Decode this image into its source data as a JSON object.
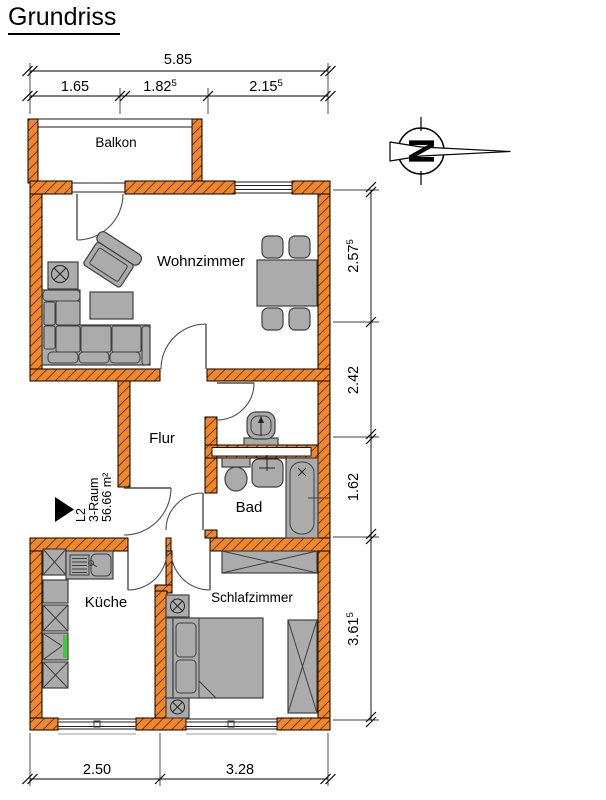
{
  "title": "Grundriss",
  "apartment": {
    "code": "L2",
    "type": "3-Raum",
    "area": "56.66 m²"
  },
  "rooms": {
    "balcony": "Balkon",
    "living_room": "Wohnzimmer",
    "hallway": "Flur",
    "bathroom": "Bad",
    "kitchen": "Küche",
    "bedroom": "Schlafzimmer"
  },
  "dimensions": {
    "top_total": {
      "main": "5.85",
      "sup": ""
    },
    "top_parts": [
      {
        "main": "1.65",
        "sup": ""
      },
      {
        "main": "1.82",
        "sup": "5"
      },
      {
        "main": "2.15",
        "sup": "5"
      }
    ],
    "right_parts": [
      {
        "main": "2.57",
        "sup": "5"
      },
      {
        "main": "2.42",
        "sup": ""
      },
      {
        "main": "1.62",
        "sup": ""
      },
      {
        "main": "3.61",
        "sup": "5"
      }
    ],
    "bottom_parts": [
      {
        "main": "2.50",
        "sup": ""
      },
      {
        "main": "3.28",
        "sup": ""
      }
    ]
  },
  "compass": {
    "letter": "N"
  },
  "colors": {
    "wall": "#F2862A",
    "hatch": "#402208",
    "furniture": "#ABABAB",
    "furniture_border": "#3F3F3F",
    "accent_green": "#3DCB3D",
    "line": "#000000"
  }
}
